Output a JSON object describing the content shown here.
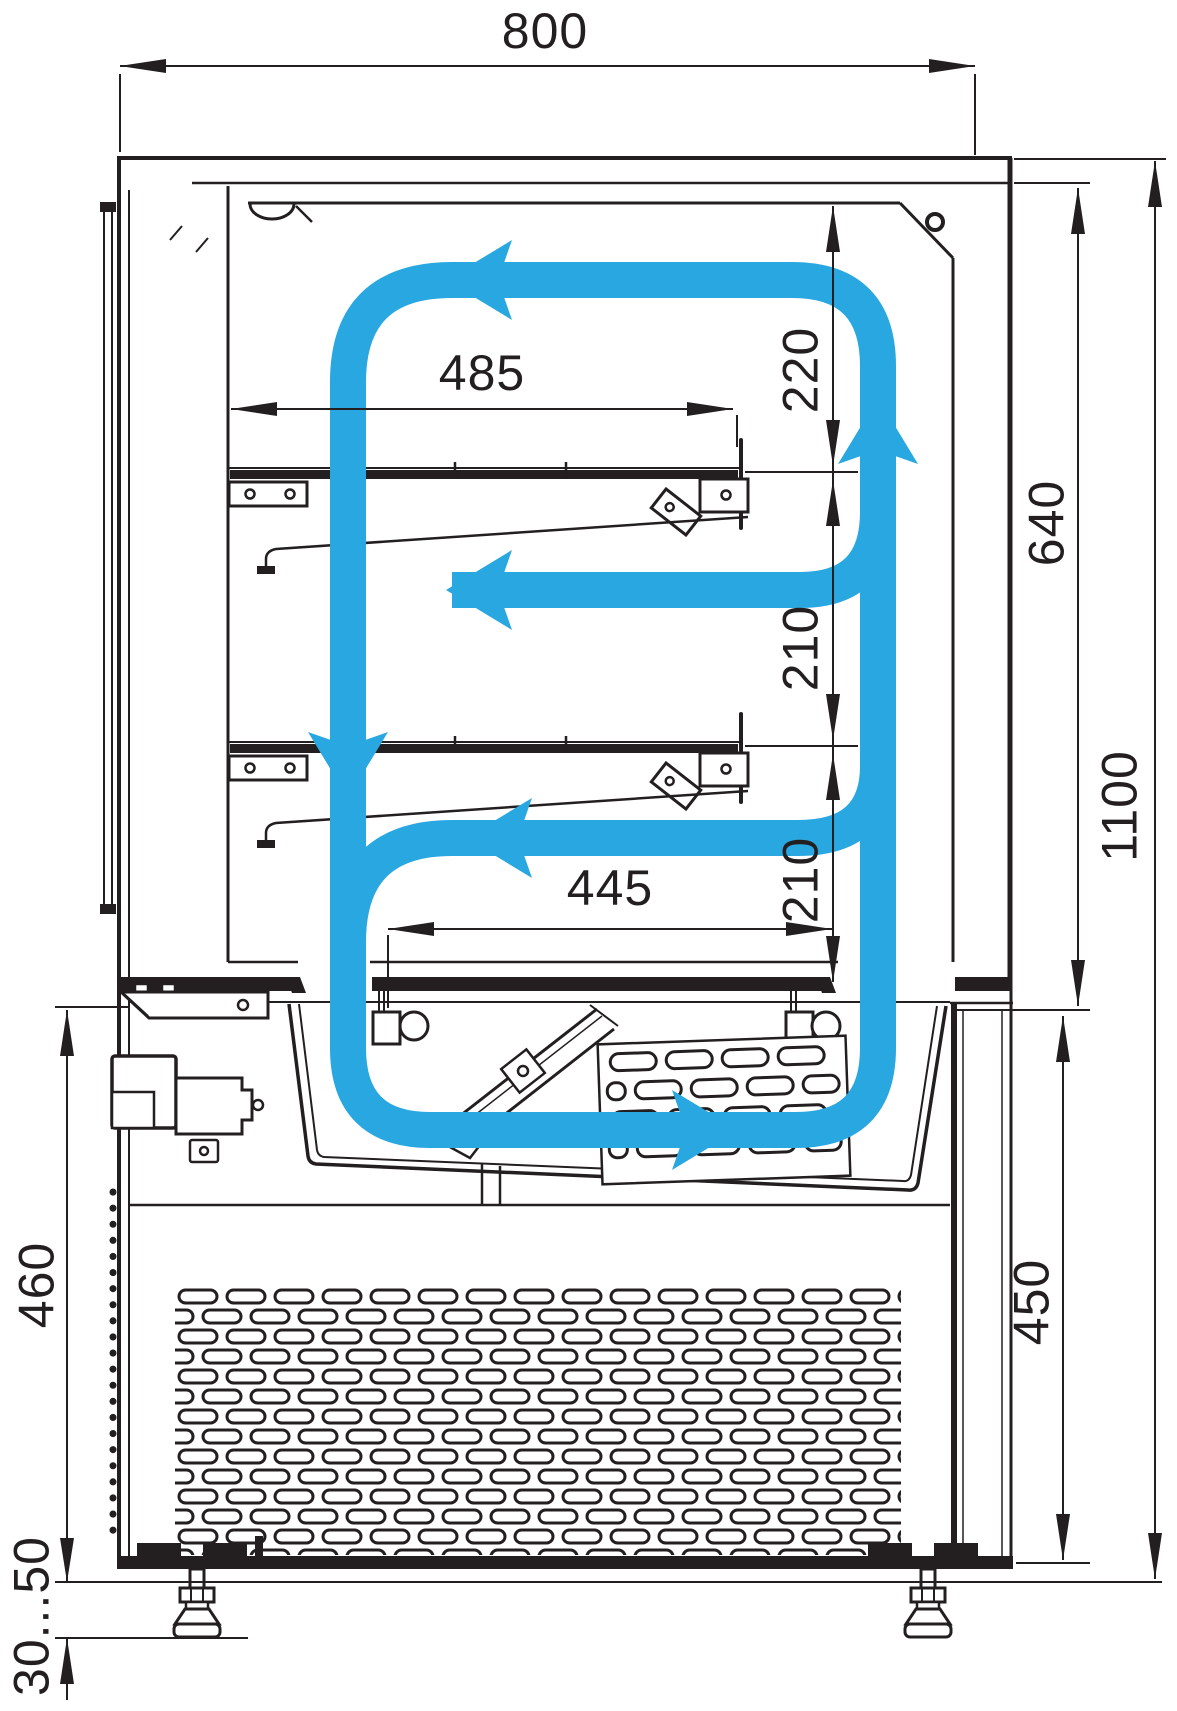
{
  "meta": {
    "type": "technical-drawing",
    "subject": "Refrigerated confectionery display case - side section with air circulation arrows and dimensions",
    "units": "mm"
  },
  "colors": {
    "line": "#231f20",
    "airflow": "#29a7e0",
    "background": "#ffffff"
  },
  "dimensions": {
    "overall_width": {
      "label": "800",
      "orientation": "horizontal"
    },
    "upper_shelf_length": {
      "label": "485",
      "orientation": "horizontal"
    },
    "top_clearance": {
      "label": "220",
      "orientation": "vertical"
    },
    "display_inner_height": {
      "label": "640",
      "orientation": "vertical"
    },
    "shelf_gap_1": {
      "label": "210",
      "orientation": "vertical"
    },
    "shelf_gap_2": {
      "label": "210",
      "orientation": "vertical"
    },
    "lower_shelf_length": {
      "label": "445",
      "orientation": "horizontal"
    },
    "overall_height": {
      "label": "1100",
      "orientation": "vertical"
    },
    "base_height_left": {
      "label": "460",
      "orientation": "vertical"
    },
    "base_height_right": {
      "label": "450",
      "orientation": "vertical"
    },
    "foot_adjustment_range": {
      "label": "30...50",
      "orientation": "vertical"
    }
  }
}
